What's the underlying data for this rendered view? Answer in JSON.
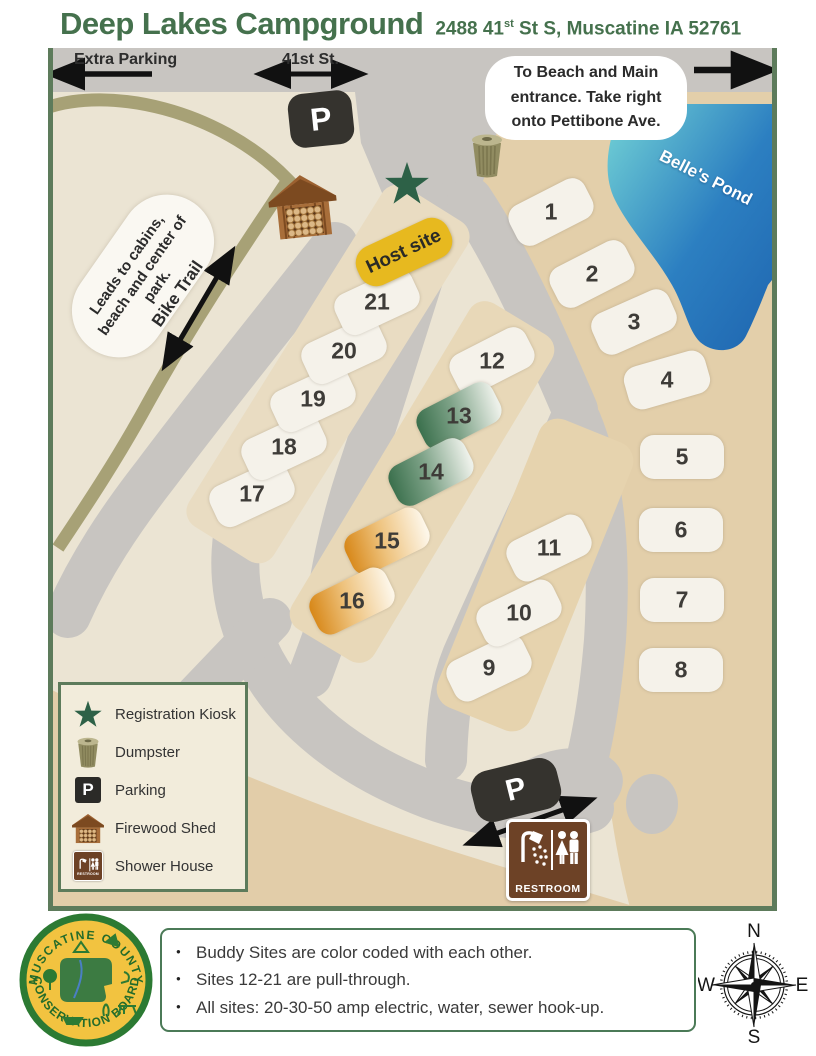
{
  "title": "Deep Lakes Campground",
  "address": {
    "prefix": "2488 41",
    "sup": "st",
    "rest": " St S, Muscatine IA 52761"
  },
  "map": {
    "labels": {
      "extra_parking": "Extra Parking",
      "street": "41st St.",
      "beach_note": [
        "To Beach and Main",
        "entrance. Take right",
        "onto Pettibone Ave."
      ],
      "pond": "Belle's Pond",
      "cabins_note": [
        "Leads to cabins,",
        "beach and center of",
        "park."
      ],
      "bike_trail": "Bike Trail",
      "parking_letter": "P",
      "restroom": "RESTROOM"
    },
    "sites": [
      {
        "label": "1",
        "x": 503,
        "y": 164,
        "rot": -27,
        "type": "std"
      },
      {
        "label": "2",
        "x": 544,
        "y": 226,
        "rot": -27,
        "type": "std"
      },
      {
        "label": "3",
        "x": 586,
        "y": 274,
        "rot": -24,
        "type": "std"
      },
      {
        "label": "4",
        "x": 619,
        "y": 332,
        "rot": -16,
        "type": "std"
      },
      {
        "label": "5",
        "x": 634,
        "y": 409,
        "rot": 0,
        "type": "std"
      },
      {
        "label": "6",
        "x": 633,
        "y": 482,
        "rot": 0,
        "type": "std"
      },
      {
        "label": "7",
        "x": 634,
        "y": 552,
        "rot": 0,
        "type": "std"
      },
      {
        "label": "8",
        "x": 633,
        "y": 622,
        "rot": 0,
        "type": "std"
      },
      {
        "label": "9",
        "x": 441,
        "y": 620,
        "rot": -26,
        "type": "std"
      },
      {
        "label": "10",
        "x": 471,
        "y": 565,
        "rot": -26,
        "type": "std"
      },
      {
        "label": "11",
        "x": 501,
        "y": 500,
        "rot": -26,
        "type": "std"
      },
      {
        "label": "12",
        "x": 444,
        "y": 313,
        "rot": -27,
        "type": "std"
      },
      {
        "label": "13",
        "x": 411,
        "y": 368,
        "rot": -27,
        "type": "green"
      },
      {
        "label": "14",
        "x": 383,
        "y": 424,
        "rot": -27,
        "type": "green"
      },
      {
        "label": "15",
        "x": 339,
        "y": 493,
        "rot": -26,
        "type": "orange"
      },
      {
        "label": "16",
        "x": 304,
        "y": 553,
        "rot": -26,
        "type": "orange"
      },
      {
        "label": "17",
        "x": 204,
        "y": 446,
        "rot": -25,
        "type": "std"
      },
      {
        "label": "18",
        "x": 236,
        "y": 399,
        "rot": -25,
        "type": "std"
      },
      {
        "label": "19",
        "x": 265,
        "y": 351,
        "rot": -25,
        "type": "std"
      },
      {
        "label": "20",
        "x": 296,
        "y": 303,
        "rot": -25,
        "type": "std"
      },
      {
        "label": "21",
        "x": 329,
        "y": 254,
        "rot": -25,
        "type": "std"
      },
      {
        "label": "Host site",
        "x": 356,
        "y": 204,
        "rot": -25,
        "type": "host"
      }
    ]
  },
  "legend": {
    "items": [
      {
        "icon": "registration-kiosk-icon",
        "label": "Registration Kiosk"
      },
      {
        "icon": "dumpster-icon",
        "label": "Dumpster"
      },
      {
        "icon": "parking-icon",
        "label": "Parking"
      },
      {
        "icon": "firewood-shed-icon",
        "label": "Firewood Shed"
      },
      {
        "icon": "shower-house-icon",
        "label": "Shower House"
      }
    ]
  },
  "notes": {
    "items": [
      "Buddy Sites are color coded with each other.",
      "Sites 12-21 are pull-through.",
      "All sites: 20-30-50 amp electric, water, sewer hook-up."
    ]
  },
  "compass": {
    "n": "N",
    "e": "E",
    "s": "S",
    "w": "W"
  },
  "logo": {
    "top": "MUSCATINE COUNTY",
    "bottom": "CONSERVATION BOARD"
  },
  "colors": {
    "title_green": "#45714d",
    "border_green": "#5d7b5b",
    "road_gray": "#c8c5c1",
    "base_beige": "#ebe4d3",
    "tan": "#e3cfaa",
    "trail_olive": "#a7a176",
    "pond_light": "#74d4d6",
    "pond_dark": "#1f66b0",
    "host_gold": "#e7b91f",
    "buddy_green": "#3c714e",
    "buddy_orange": "#d8891b",
    "sign_brown": "#6d4226"
  }
}
